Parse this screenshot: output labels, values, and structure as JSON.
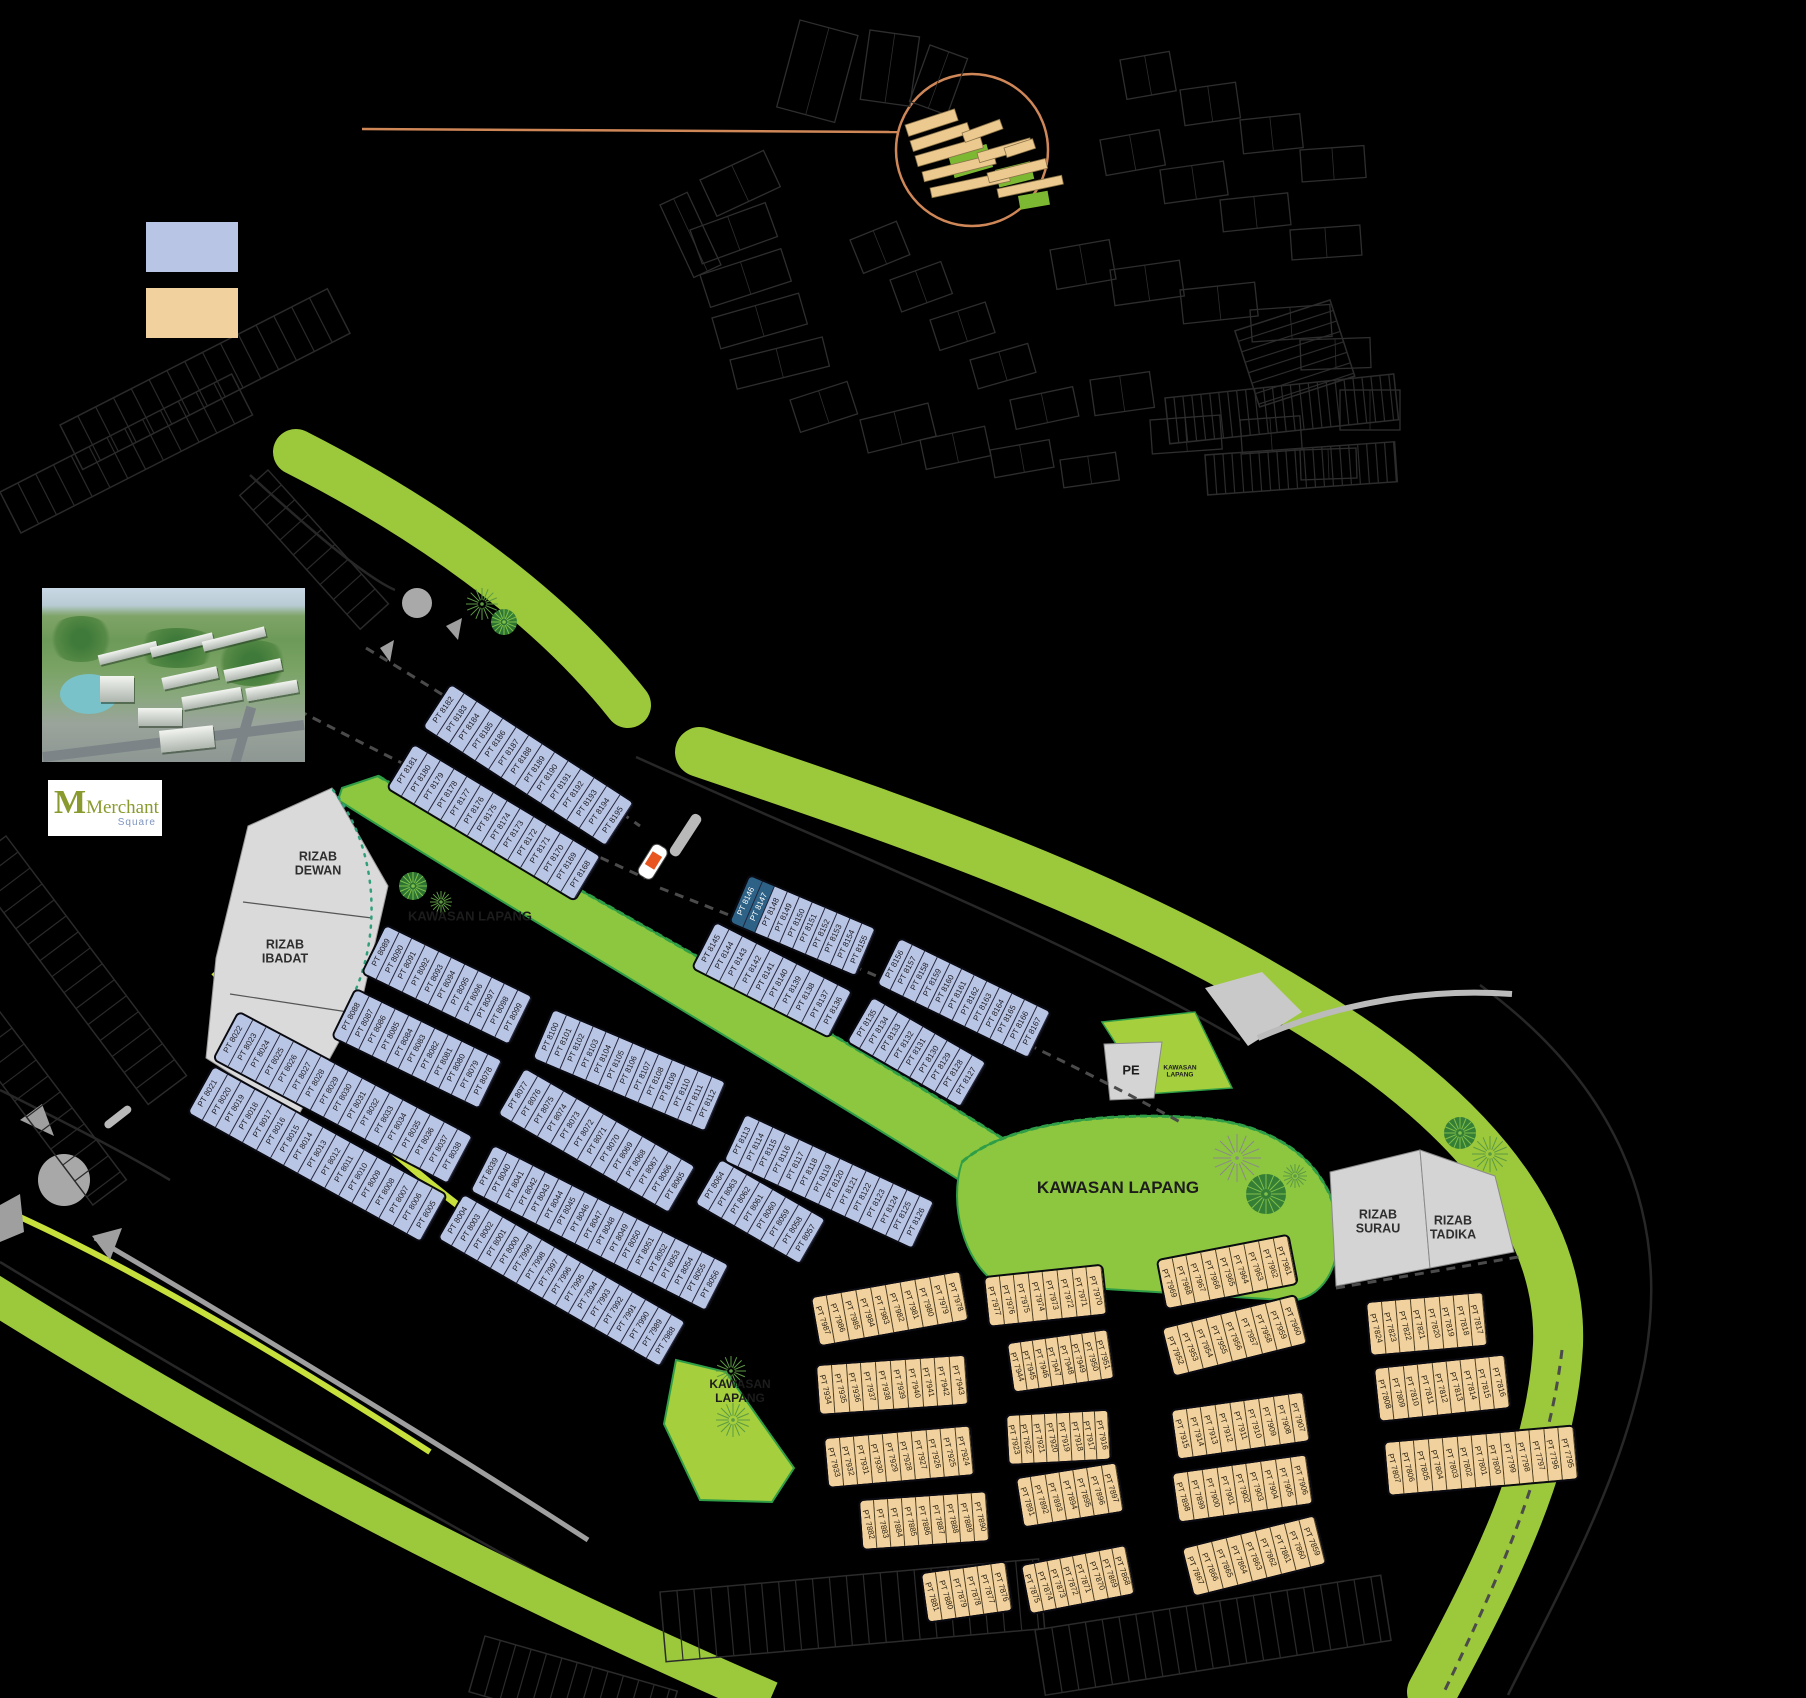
{
  "title": "Merchant Square site plan",
  "logo": {
    "title": "Merchant",
    "subtitle": "Square"
  },
  "legend": {
    "swatches": [
      {
        "name": "blue-lots",
        "color": "#b9c5e4"
      },
      {
        "name": "tan-lots",
        "color": "#f1d19d"
      }
    ]
  },
  "colors": {
    "accent_orange": "#cf8758",
    "lot_blue": "#b9c5e4",
    "lot_tan": "#f1d19d",
    "open_green": "#8dc63f",
    "verge_green": "#9cc83b",
    "reserve_gray": "#d8d8d8",
    "highlight_blue": "#2d6286"
  },
  "reserves": {
    "dewan1": "RIZAB",
    "dewan2": "DEWAN",
    "ibadat1": "RIZAB",
    "ibadat2": "IBADAT",
    "surau1": "RIZAB",
    "surau2": "SURAU",
    "tadika1": "RIZAB",
    "tadika2": "TADIKA",
    "pe": "PE"
  },
  "open_spaces": {
    "label": "KAWASAN LAPANG",
    "word1": "KAWASAN",
    "word2": "LAPANG"
  },
  "highlight": {
    "lots": [
      "PT 8146",
      "PT 8147"
    ],
    "color": "#2d6286"
  },
  "lot_rows": [
    {
      "id": "r1",
      "lots": [
        "PT 8182",
        "PT 8183",
        "PT 8184",
        "PT 8185",
        "PT 8186",
        "PT 8187",
        "PT 8188",
        "PT 8189",
        "PT 8190",
        "PT 8191",
        "PT 8192",
        "PT 8193",
        "PT 8194",
        "PT 8195"
      ]
    },
    {
      "id": "r2",
      "lots": [
        "PT 8181",
        "PT 8180",
        "PT 8179",
        "PT 8178",
        "PT 8177",
        "PT 8176",
        "PT 8175",
        "PT 8174",
        "PT 8173",
        "PT 8172",
        "PT 8171",
        "PT 8170",
        "PT 8169",
        "PT 8168"
      ]
    },
    {
      "id": "r3",
      "lots": [
        "PT 8089",
        "PT 8090",
        "PT 8091",
        "PT 8092",
        "PT 8093",
        "PT 8094",
        "PT 8095",
        "PT 8096",
        "PT 8097",
        "PT 8098",
        "PT 8099"
      ]
    },
    {
      "id": "r4",
      "lots": [
        "PT 8088",
        "PT 8087",
        "PT 8086",
        "PT 8085",
        "PT 8084",
        "PT 8083",
        "PT 8082",
        "PT 8081",
        "PT 8080",
        "PT 8079",
        "PT 8078"
      ]
    },
    {
      "id": "r5",
      "lots": [
        "PT 8022",
        "PT 8023",
        "PT 8024",
        "PT 8025",
        "PT 8026",
        "PT 8027",
        "PT 8028",
        "PT 8029",
        "PT 8030",
        "PT 8031",
        "PT 8032",
        "PT 8033",
        "PT 8034",
        "PT 8035",
        "PT 8036",
        "PT 8037",
        "PT 8038"
      ]
    },
    {
      "id": "r6",
      "lots": [
        "PT 8021",
        "PT 8020",
        "PT 8019",
        "PT 8018",
        "PT 8017",
        "PT 8016",
        "PT 8015",
        "PT 8014",
        "PT 8013",
        "PT 8012",
        "PT 8011",
        "PT 8010",
        "PT 8009",
        "PT 8008",
        "PT 8007",
        "PT 8006",
        "PT 8005"
      ]
    },
    {
      "id": "r7",
      "lots": [
        "PT 8004",
        "PT 8003",
        "PT 8002",
        "PT 8001",
        "PT 8000",
        "PT 7999",
        "PT 7998",
        "PT 7997",
        "PT 7996",
        "PT 7995",
        "PT 7994",
        "PT 7993",
        "PT 7992",
        "PT 7991",
        "PT 7990",
        "PT 7989",
        "PT 7988"
      ]
    },
    {
      "id": "r8",
      "lots": [
        "PT 8100",
        "PT 8101",
        "PT 8102",
        "PT 8103",
        "PT 8104",
        "PT 8105",
        "PT 8106",
        "PT 8107",
        "PT 8108",
        "PT 8109",
        "PT 8110",
        "PT 8111",
        "PT 8112"
      ]
    },
    {
      "id": "r9",
      "lots": [
        "PT 8077",
        "PT 8076",
        "PT 8075",
        "PT 8074",
        "PT 8073",
        "PT 8072",
        "PT 8071",
        "PT 8070",
        "PT 8069",
        "PT 8068",
        "PT 8067",
        "PT 8066",
        "PT 8065"
      ]
    },
    {
      "id": "r10",
      "lots": [
        "PT 8113",
        "PT 8114",
        "PT 8115",
        "PT 8116",
        "PT 8117",
        "PT 8118",
        "PT 8119",
        "PT 8120",
        "PT 8121",
        "PT 8122",
        "PT 8123",
        "PT 8124",
        "PT 8125",
        "PT 8126"
      ]
    },
    {
      "id": "r11",
      "lots": [
        "PT 8064",
        "PT 8063",
        "PT 8062",
        "PT 8061",
        "PT 8060",
        "PT 8059",
        "PT 8058",
        "PT 8057"
      ]
    },
    {
      "id": "r12",
      "lots": [
        "PT 8039",
        "PT 8040",
        "PT 8041",
        "PT 8042",
        "PT 8043",
        "PT 8044",
        "PT 8045",
        "PT 8046",
        "PT 8047",
        "PT 8048",
        "PT 8049",
        "PT 8050",
        "PT 8051",
        "PT 8052",
        "PT 8053",
        "PT 8054",
        "PT 8055",
        "PT 8056"
      ]
    },
    {
      "id": "r13",
      "lots": [
        "PT 8145",
        "PT 8144",
        "PT 8143",
        "PT 8142",
        "PT 8141",
        "PT 8140",
        "PT 8139",
        "PT 8138",
        "PT 8137",
        "PT 8136"
      ]
    },
    {
      "id": "r14",
      "lots": [
        "PT 8146",
        "PT 8147",
        "PT 8148",
        "PT 8149",
        "PT 8150",
        "PT 8151",
        "PT 8152",
        "PT 8153",
        "PT 8154",
        "PT 8155"
      ]
    },
    {
      "id": "r15",
      "lots": [
        "PT 8156",
        "PT 8157",
        "PT 8158",
        "PT 8159",
        "PT 8160",
        "PT 8161",
        "PT 8162",
        "PT 8163",
        "PT 8164",
        "PT 8165",
        "PT 8166",
        "PT 8167"
      ]
    },
    {
      "id": "r16",
      "lots": [
        "PT 8135",
        "PT 8134",
        "PT 8133",
        "PT 8132",
        "PT 8131",
        "PT 8130",
        "PT 8129",
        "PT 8128",
        "PT 8127"
      ]
    },
    {
      "id": "t1",
      "lots": [
        "PT 7987",
        "PT 7986",
        "PT 7985",
        "PT 7984",
        "PT 7983",
        "PT 7982",
        "PT 7981",
        "PT 7980",
        "PT 7979",
        "PT 7978"
      ]
    },
    {
      "id": "t2",
      "lots": [
        "PT 7977",
        "PT 7976",
        "PT 7975",
        "PT 7974",
        "PT 7973",
        "PT 7972",
        "PT 7971",
        "PT 7970"
      ]
    },
    {
      "id": "t3",
      "lots": [
        "PT 7969",
        "PT 7968",
        "PT 7967",
        "PT 7966",
        "PT 7965",
        "PT 7964",
        "PT 7963",
        "PT 7962",
        "PT 7961"
      ]
    },
    {
      "id": "t4",
      "lots": [
        "PT 7934",
        "PT 7935",
        "PT 7936",
        "PT 7937",
        "PT 7938",
        "PT 7939",
        "PT 7940",
        "PT 7941",
        "PT 7942",
        "PT 7943"
      ]
    },
    {
      "id": "t5",
      "lots": [
        "PT 7944",
        "PT 7945",
        "PT 7946",
        "PT 7947",
        "PT 7948",
        "PT 7949",
        "PT 7950",
        "PT 7951"
      ]
    },
    {
      "id": "t6",
      "lots": [
        "PT 7952",
        "PT 7953",
        "PT 7954",
        "PT 7955",
        "PT 7956",
        "PT 7957",
        "PT 7958",
        "PT 7959",
        "PT 7960"
      ]
    },
    {
      "id": "t7",
      "lots": [
        "PT 7933",
        "PT 7932",
        "PT 7931",
        "PT 7930",
        "PT 7929",
        "PT 7928",
        "PT 7927",
        "PT 7926",
        "PT 7925",
        "PT 7924"
      ]
    },
    {
      "id": "t8",
      "lots": [
        "PT 7923",
        "PT 7922",
        "PT 7921",
        "PT 7920",
        "PT 7919",
        "PT 7918",
        "PT 7917",
        "PT 7916"
      ]
    },
    {
      "id": "t9",
      "lots": [
        "PT 7915",
        "PT 7914",
        "PT 7913",
        "PT 7912",
        "PT 7911",
        "PT 7910",
        "PT 7909",
        "PT 7908",
        "PT 7907"
      ]
    },
    {
      "id": "t10",
      "lots": [
        "PT 7882",
        "PT 7883",
        "PT 7884",
        "PT 7885",
        "PT 7886",
        "PT 7887",
        "PT 7888",
        "PT 7889",
        "PT 7890"
      ]
    },
    {
      "id": "t11",
      "lots": [
        "PT 7891",
        "PT 7892",
        "PT 7893",
        "PT 7894",
        "PT 7895",
        "PT 7896",
        "PT 7897"
      ]
    },
    {
      "id": "t12",
      "lots": [
        "PT 7898",
        "PT 7899",
        "PT 7900",
        "PT 7901",
        "PT 7902",
        "PT 7903",
        "PT 7904",
        "PT 7905",
        "PT 7906"
      ]
    },
    {
      "id": "t13",
      "lots": [
        "PT 7875",
        "PT 7874",
        "PT 7873",
        "PT 7872",
        "PT 7871",
        "PT 7870",
        "PT 7869",
        "PT 7868"
      ]
    },
    {
      "id": "t14",
      "lots": [
        "PT 7881",
        "PT 7880",
        "PT 7879",
        "PT 7878",
        "PT 7877",
        "PT 7876"
      ]
    },
    {
      "id": "t15",
      "lots": [
        "PT 7867",
        "PT 7866",
        "PT 7865",
        "PT 7864",
        "PT 7863",
        "PT 7862",
        "PT 7861",
        "PT 7860",
        "PT 7859"
      ]
    },
    {
      "id": "t16",
      "lots": [
        "PT 7824",
        "PT 7823",
        "PT 7822",
        "PT 7821",
        "PT 7820",
        "PT 7819",
        "PT 7818",
        "PT 7817"
      ]
    },
    {
      "id": "t17",
      "lots": [
        "PT 7808",
        "PT 7809",
        "PT 7810",
        "PT 7811",
        "PT 7812",
        "PT 7813",
        "PT 7814",
        "PT 7815",
        "PT 7816"
      ]
    },
    {
      "id": "t18",
      "lots": [
        "PT 7807",
        "PT 7806",
        "PT 7805",
        "PT 7804",
        "PT 7803",
        "PT 7802",
        "PT 7801",
        "PT 7800",
        "PT 7799",
        "PT 7798",
        "PT 7797",
        "PT 7796",
        "PT 7795"
      ]
    }
  ]
}
